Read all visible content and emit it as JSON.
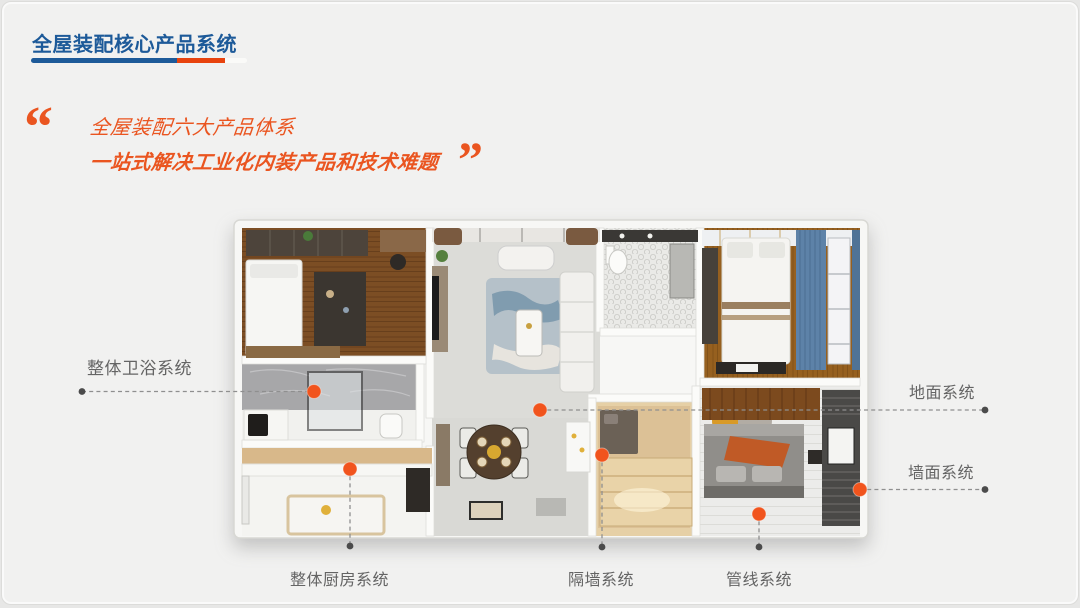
{
  "slide": {
    "background_color": "#f1f1f0",
    "accent_blue": "#1d5a99",
    "accent_orange": "#ea5520",
    "label_gray": "#646464"
  },
  "header": {
    "title": "全屋装配核心产品系统",
    "underline_colors": [
      "#1d5a99",
      "#e8430e",
      "#fafaf8"
    ]
  },
  "quote": {
    "open_mark": "“",
    "close_mark": "”",
    "line1": "全屋装配六大产品体系",
    "line2": "一站式解决工业化内装产品和技术难题"
  },
  "floorplan": {
    "callout_labels": [
      "整体卫浴系统",
      "地面系统",
      "墙面系统",
      "整体厨房系统",
      "隔墙系统",
      "管线系统"
    ],
    "hotspot_color": "#f1541d",
    "line_color": "#8f8f8f",
    "endpoint_color": "#4b4b4b"
  }
}
